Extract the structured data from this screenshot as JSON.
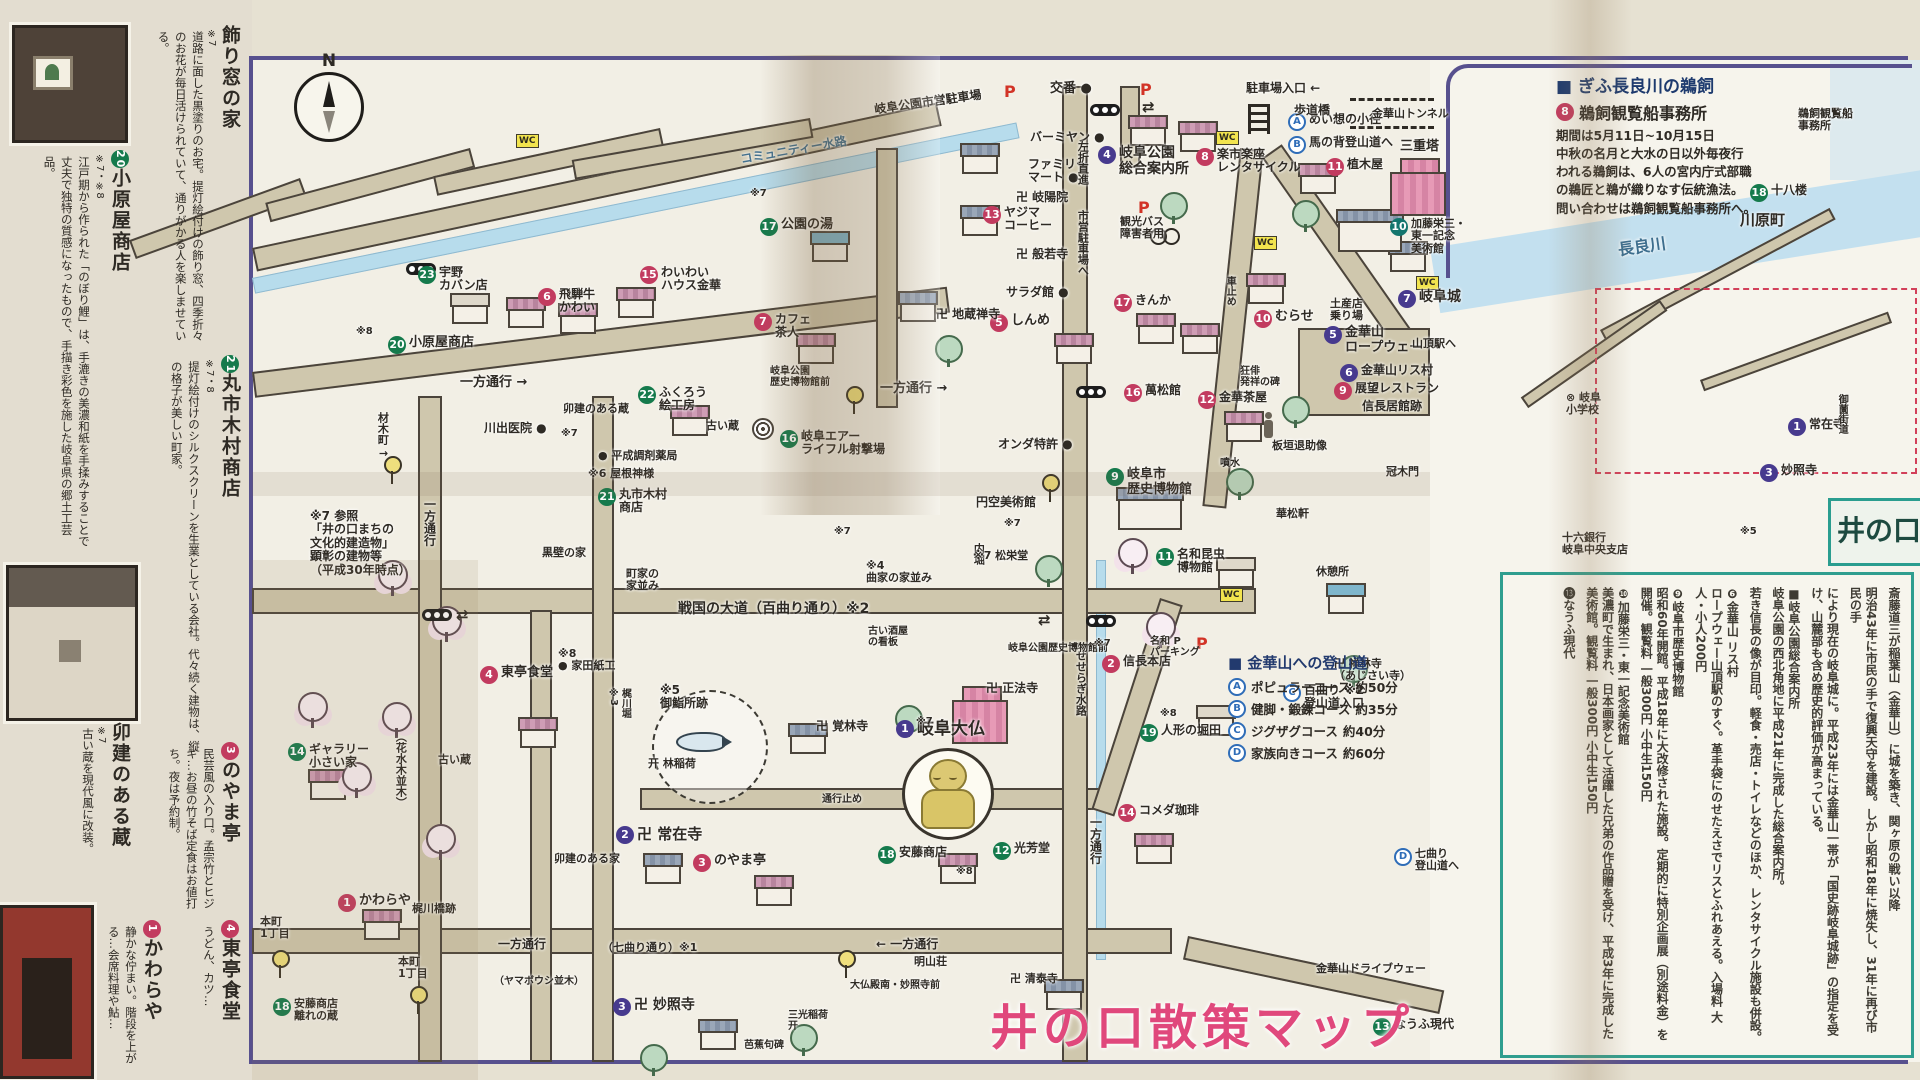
{
  "title": {
    "text": "井の口散策マップ"
  },
  "compass": {
    "n": "N"
  },
  "colors": {
    "pink": "#c23b5f",
    "green": "#157a4c",
    "teal": "#13756d",
    "purple": "#473a8e",
    "letter_blue": "#2f6db8",
    "title_pink": "#e0487c",
    "road": "#cfc7ad",
    "water": "#b7dcec",
    "accent_teal": "#2f9e8f",
    "sheet_border": "#57508e"
  },
  "legend": {
    "title": "■ 金華山への登山道",
    "items": [
      {
        "key": "A",
        "label": "ポピュラーコース",
        "time": "約50分"
      },
      {
        "key": "B",
        "label": "健脚・鍛錬コース",
        "time": "約35分"
      },
      {
        "key": "C",
        "label": "ジグザグコース",
        "time": "約40分"
      },
      {
        "key": "D",
        "label": "家族向きコース",
        "time": "約60分"
      }
    ]
  },
  "right": {
    "ukai": {
      "heading": "■ ぎふ長良川の鵜飼",
      "sub_num": "8",
      "sub_text": "鵜飼観覧船事務所",
      "body": "期間は5月11日~10月15日\n中秋の名月と大水の日以外毎夜行\nわれる鵜飼は、6人の宮内庁式部職\nの鵜匠と鵜が織りなす伝統漁法。\n問い合わせは鵜飼観覧船事務所へ。"
    },
    "inokuchi": "井の口",
    "columns": [
      "斎藤道三が稲葉山（金華山）に城を築き、関ヶ原の戦い以降",
      "明治43年に市民の手で復興天守を建設。しかし昭和18年に焼失し、31年に再び市民の手",
      "により現在の岐阜城に。平成23年には金華山一帯が「国史跡岐阜城跡」の指定を受け、山麓部も含め歴史的評価が高まっている。",
      "■岐阜公園総合案内所\n岐阜公園の西北角地に平成21年に完成した総合案内所。",
      "若き信長の像が目印。軽食・売店・トイレなどのほか、レンタサイクル施設も併設。",
      "❻金華山 リス村\nロープウェー山頂駅のすぐ。革手袋にのせたえさでリスとふれあえる。入場料 大人・小人200円",
      "❾岐阜市歴史博物館\n昭和60年開館。平成18年に大改修された施設。定期的に特別企画展（別途料金）を開催。観覧料 一般300円 小中生150円",
      "❿加藤栄三・東一記念美術館\n美濃町で生まれ、日本画家として活躍した兄弟の作品贈を受け、平成3年に完成した美術館。観覧料 一般300円 小中生150円",
      "⓭なうふ現代"
    ]
  },
  "left": {
    "sections": [
      {
        "num": "",
        "nc": "",
        "title": "飾り窓の家",
        "note": "※7",
        "body": "道路に面した黒塗りのお宅。提灯絵付けの飾り窓、四季折々のお花が毎日活けられていて、通りがかる人を楽しませている。"
      },
      {
        "num": "20",
        "nc": "green",
        "title": "小原屋商店",
        "note": "※7・※8",
        "body": "江戸期から作られた「のぼり鯉」は、手漉きの美濃和紙を手揉みすることで丈夫で独特の質感になったもので、手描き彩色を施した岐阜県の郷土工芸品。"
      },
      {
        "num": "21",
        "nc": "green",
        "title": "丸市木村商店",
        "note": "※7・8",
        "body": "提灯絵付けのシルクスクリーンを生業としている会社。代々続く建物は、縦の格子が美しい町家。"
      },
      {
        "num": "",
        "nc": "",
        "title": "卯建のある蔵",
        "note": "※7",
        "body": "古い蔵を現代風に改装。"
      },
      {
        "num": "3",
        "nc": "pink",
        "title": "のやま亭",
        "note": "",
        "body": "民芸風の入り口。孟宗竹とヒジキ…お昼の竹そば定食はお値打ち。夜は予約制。"
      },
      {
        "num": "1",
        "nc": "pink",
        "title": "かわらや",
        "note": "",
        "body": "静かな佇まい。階段を上がる…会席料理や鮎…"
      },
      {
        "num": "4",
        "nc": "pink",
        "title": "東亭食堂",
        "note": "",
        "body": "うどん、カツ…"
      }
    ]
  },
  "map": {
    "items": [
      {
        "s": "purple",
        "n": "1",
        "t": "岐阜大仏",
        "x": 896,
        "y": 720,
        "fs": 17,
        "b": 1
      },
      {
        "s": "purple",
        "n": "2",
        "t": "卍 常在寺",
        "x": 616,
        "y": 826,
        "fs": 15
      },
      {
        "s": "purple",
        "n": "3",
        "t": "卍 妙照寺",
        "x": 613,
        "y": 998,
        "fs": 14
      },
      {
        "s": "purple",
        "n": "4",
        "t": "岐阜公園\n総合案内所",
        "x": 1098,
        "y": 146,
        "fs": 14,
        "b": 1
      },
      {
        "s": "purple",
        "n": "5",
        "t": "金華山\nロープウェー",
        "x": 1324,
        "y": 326,
        "fs": 13
      },
      {
        "s": "purple",
        "n": "6",
        "t": "金華山リス村",
        "x": 1340,
        "y": 364,
        "fs": 12
      },
      {
        "s": "purple",
        "n": "7",
        "t": "岐阜城",
        "x": 1398,
        "y": 290,
        "fs": 14
      },
      {
        "s": "letter",
        "n": "A",
        "t": "めい想の小径",
        "x": 1288,
        "y": 113,
        "fs": 12
      },
      {
        "s": "letter",
        "n": "B",
        "t": "馬の背登山道へ",
        "x": 1288,
        "y": 136,
        "fs": 12
      },
      {
        "s": "letter",
        "n": "C",
        "t": "百曲り ※2\n登山道入口",
        "x": 1283,
        "y": 684,
        "fs": 12
      },
      {
        "s": "letter",
        "n": "D",
        "t": "七曲り\n登山道へ",
        "x": 1394,
        "y": 848,
        "fs": 11
      },
      {
        "s": "pink",
        "n": "1",
        "t": "かわらや",
        "x": 338,
        "y": 894,
        "fs": 13
      },
      {
        "s": "pink",
        "n": "2",
        "t": "信長本店",
        "x": 1102,
        "y": 655,
        "fs": 12
      },
      {
        "s": "pink",
        "n": "3",
        "t": "のやま亭",
        "x": 693,
        "y": 854,
        "fs": 13
      },
      {
        "s": "pink",
        "n": "4",
        "t": "東亭食堂",
        "x": 480,
        "y": 666,
        "fs": 13
      },
      {
        "s": "pink",
        "n": "5",
        "t": "しんめ",
        "x": 990,
        "y": 314,
        "fs": 13
      },
      {
        "s": "pink",
        "n": "6",
        "t": "飛騨牛\nかわい",
        "x": 538,
        "y": 288,
        "fs": 12
      },
      {
        "s": "pink",
        "n": "7",
        "t": "カフェ\n茶人",
        "x": 754,
        "y": 313,
        "fs": 12
      },
      {
        "s": "pink",
        "n": "8",
        "t": "楽市楽座\nレンタサイクル",
        "x": 1196,
        "y": 148,
        "fs": 12
      },
      {
        "s": "pink",
        "n": "9",
        "t": "展望レストラン",
        "x": 1334,
        "y": 382,
        "fs": 12
      },
      {
        "s": "pink",
        "n": "10",
        "t": "むらせ",
        "x": 1254,
        "y": 310,
        "fs": 13
      },
      {
        "s": "pink",
        "n": "11",
        "t": "植木屋",
        "x": 1326,
        "y": 158,
        "fs": 12
      },
      {
        "s": "pink",
        "n": "12",
        "t": "金華茶屋",
        "x": 1198,
        "y": 391,
        "fs": 12
      },
      {
        "s": "pink",
        "n": "13",
        "t": "ヤジマ\nコーヒー",
        "x": 983,
        "y": 206,
        "fs": 12
      },
      {
        "s": "pink",
        "n": "14",
        "t": "コメダ珈琲",
        "x": 1118,
        "y": 804,
        "fs": 12
      },
      {
        "s": "pink",
        "n": "15",
        "t": "わいわい\nハウス金華",
        "x": 640,
        "y": 266,
        "fs": 12
      },
      {
        "s": "pink",
        "n": "16",
        "t": "萬松館",
        "x": 1124,
        "y": 384,
        "fs": 12
      },
      {
        "s": "pink",
        "n": "17",
        "t": "きんか",
        "x": 1114,
        "y": 294,
        "fs": 12
      },
      {
        "s": "green",
        "n": "9",
        "t": "岐阜市\n歴史博物館",
        "x": 1106,
        "y": 468,
        "fs": 13,
        "b": 1
      },
      {
        "s": "teal",
        "n": "10",
        "t": "加藤栄三・\n東一記念\n美術館",
        "x": 1390,
        "y": 218,
        "fs": 11
      },
      {
        "s": "green",
        "n": "11",
        "t": "名和昆虫\n博物館",
        "x": 1156,
        "y": 548,
        "fs": 12
      },
      {
        "s": "green",
        "n": "12",
        "t": "光芳堂",
        "x": 993,
        "y": 842,
        "fs": 12
      },
      {
        "s": "green",
        "n": "13",
        "t": "なうふ現代",
        "x": 1373,
        "y": 1018,
        "fs": 12
      },
      {
        "s": "green",
        "n": "14",
        "t": "ギャラリー\n小さい家",
        "x": 288,
        "y": 743,
        "fs": 12
      },
      {
        "s": "green",
        "n": "16",
        "t": "岐阜エアー\nライフル射撃場",
        "x": 780,
        "y": 430,
        "fs": 12
      },
      {
        "s": "green",
        "n": "17",
        "t": "公園の湯",
        "x": 760,
        "y": 218,
        "fs": 13
      },
      {
        "s": "green",
        "n": "18",
        "t": "安藤商店",
        "x": 878,
        "y": 846,
        "fs": 12
      },
      {
        "s": "green",
        "n": "18",
        "t": "安藤商店\n離れの蔵",
        "x": 273,
        "y": 998,
        "fs": 11
      },
      {
        "s": "green",
        "n": "19",
        "t": "人形の堀田",
        "x": 1140,
        "y": 724,
        "fs": 12
      },
      {
        "s": "green",
        "n": "20",
        "t": "小原屋商店",
        "x": 388,
        "y": 336,
        "fs": 13
      },
      {
        "s": "green",
        "n": "21",
        "t": "丸市木村\n商店",
        "x": 598,
        "y": 488,
        "fs": 12
      },
      {
        "s": "green",
        "n": "22",
        "t": "ふくろう\n絵工房",
        "x": 638,
        "y": 386,
        "fs": 12
      },
      {
        "s": "green",
        "n": "23",
        "t": "宇野\nカバン店",
        "x": 418,
        "y": 266,
        "fs": 12
      },
      {
        "s": "green",
        "n": "18",
        "t": "十八楼",
        "x": 1750,
        "y": 184,
        "fs": 12
      },
      {
        "s": "purple",
        "n": "1",
        "t": "常在寺",
        "x": 1788,
        "y": 418,
        "fs": 12
      },
      {
        "s": "purple",
        "n": "3",
        "t": "妙照寺",
        "x": 1760,
        "y": 464,
        "fs": 12
      },
      {
        "t": "交番 ●",
        "x": 1050,
        "y": 82,
        "fs": 13
      },
      {
        "t": "駐車場入口 ←",
        "x": 1246,
        "y": 82,
        "fs": 12
      },
      {
        "t": "歩道橋",
        "x": 1294,
        "y": 104,
        "fs": 12
      },
      {
        "t": "金華山トンネル",
        "x": 1372,
        "y": 108,
        "fs": 11
      },
      {
        "t": "三重塔",
        "x": 1400,
        "y": 140,
        "fs": 13
      },
      {
        "t": "卍 岐陽院",
        "x": 1016,
        "y": 191,
        "fs": 12
      },
      {
        "t": "卍 般若寺",
        "x": 1016,
        "y": 248,
        "fs": 12
      },
      {
        "t": "バーミヤン ●",
        "x": 1030,
        "y": 131,
        "fs": 12
      },
      {
        "t": "ファミリー\nマート ●",
        "x": 1028,
        "y": 158,
        "fs": 12
      },
      {
        "t": "左折直進",
        "x": 1076,
        "y": 141,
        "v": 1,
        "fs": 11
      },
      {
        "t": "市営駐車場へ",
        "x": 1076,
        "y": 210,
        "v": 1,
        "fs": 11
      },
      {
        "t": "サラダ館 ●",
        "x": 1006,
        "y": 286,
        "fs": 12
      },
      {
        "t": "卍 地蔵禅寺",
        "x": 936,
        "y": 308,
        "fs": 12
      },
      {
        "t": "観光バス\n障害者用",
        "x": 1120,
        "y": 216,
        "fs": 11
      },
      {
        "t": "車止め",
        "x": 1224,
        "y": 276,
        "v": 1,
        "fs": 10
      },
      {
        "t": "土産店\n乗り場",
        "x": 1330,
        "y": 298,
        "fs": 11
      },
      {
        "t": "山頂駅へ",
        "x": 1412,
        "y": 338,
        "fs": 11
      },
      {
        "t": "信長居館跡",
        "x": 1362,
        "y": 400,
        "fs": 12
      },
      {
        "t": "板垣退助像",
        "x": 1272,
        "y": 440,
        "fs": 11
      },
      {
        "t": "冠木門",
        "x": 1386,
        "y": 466,
        "fs": 11
      },
      {
        "t": "噴水",
        "x": 1220,
        "y": 458,
        "fs": 10
      },
      {
        "t": "華松軒",
        "x": 1276,
        "y": 508,
        "fs": 11
      },
      {
        "t": "休憩所",
        "x": 1316,
        "y": 566,
        "fs": 11
      },
      {
        "t": "卍 禅林寺\n（あじさい寺）",
        "x": 1334,
        "y": 658,
        "fs": 11
      },
      {
        "t": "狂俳\n発祥の碑",
        "x": 1240,
        "y": 366,
        "fs": 10
      },
      {
        "t": "一方通行 →",
        "x": 460,
        "y": 376,
        "fs": 13
      },
      {
        "t": "一方通行 →",
        "x": 880,
        "y": 382,
        "fs": 13
      },
      {
        "t": "一方通行",
        "x": 1088,
        "y": 816,
        "v": 1,
        "fs": 12
      },
      {
        "t": "← 一方通行",
        "x": 876,
        "y": 938,
        "fs": 12
      },
      {
        "t": "一方通行",
        "x": 498,
        "y": 938,
        "fs": 12
      },
      {
        "t": "一方通行",
        "x": 422,
        "y": 498,
        "v": 1,
        "fs": 12
      },
      {
        "t": "材木町 ↑",
        "x": 376,
        "y": 412,
        "v": 1,
        "fs": 11
      },
      {
        "t": "本町\n1丁目",
        "x": 260,
        "y": 916,
        "fs": 11
      },
      {
        "t": "本町\n1丁目",
        "x": 398,
        "y": 956,
        "fs": 11
      },
      {
        "t": "戦国の大道（百曲り通り）※2",
        "x": 678,
        "y": 602,
        "fs": 14,
        "b": 1
      },
      {
        "t": "（七曲り通り）※1",
        "x": 602,
        "y": 942,
        "fs": 11
      },
      {
        "t": "（ヤマボウシ並木）",
        "x": 494,
        "y": 976,
        "fs": 10
      },
      {
        "t": "（花水木並木）",
        "x": 394,
        "y": 731,
        "v": 1,
        "fs": 11
      },
      {
        "t": "せせらぎ水路",
        "x": 1074,
        "y": 650,
        "v": 1,
        "fs": 11
      },
      {
        "t": "内堀",
        "x": 972,
        "y": 543,
        "v": 1,
        "fs": 11
      },
      {
        "t": "梶川堀\n※3",
        "x": 608,
        "y": 688,
        "v": 1,
        "fs": 10
      },
      {
        "t": "梶川橋跡",
        "x": 412,
        "y": 903,
        "fs": 11
      },
      {
        "t": "※5\n御鮨所跡",
        "x": 660,
        "y": 684,
        "fs": 12
      },
      {
        "t": "※8\n● 家田紙工",
        "x": 558,
        "y": 648,
        "fs": 11
      },
      {
        "t": "古い蔵",
        "x": 706,
        "y": 420,
        "fs": 11
      },
      {
        "t": "古い蔵",
        "x": 438,
        "y": 754,
        "fs": 11
      },
      {
        "t": "卯建のある蔵",
        "x": 563,
        "y": 403,
        "fs": 11
      },
      {
        "t": "卯建のある家",
        "x": 554,
        "y": 853,
        "fs": 11
      },
      {
        "t": "黒壁の家",
        "x": 542,
        "y": 547,
        "fs": 11
      },
      {
        "t": "町家の\n家並み",
        "x": 626,
        "y": 568,
        "fs": 11
      },
      {
        "t": "※4\n曲家の家並み",
        "x": 866,
        "y": 560,
        "fs": 11
      },
      {
        "t": "古い酒屋\nの看板",
        "x": 868,
        "y": 626,
        "fs": 10
      },
      {
        "t": "※6 屋根神様",
        "x": 588,
        "y": 468,
        "fs": 11
      },
      {
        "t": "● 平成調剤薬局",
        "x": 598,
        "y": 450,
        "fs": 11
      },
      {
        "t": "川出医院 ●",
        "x": 484,
        "y": 422,
        "fs": 12
      },
      {
        "t": "オンダ特許 ●",
        "x": 998,
        "y": 438,
        "fs": 12
      },
      {
        "t": "円空美術館",
        "x": 976,
        "y": 496,
        "fs": 12
      },
      {
        "t": "※7 松栄堂",
        "x": 973,
        "y": 550,
        "fs": 11
      },
      {
        "t": "岐阜公園\n歴史博物館前",
        "x": 770,
        "y": 366,
        "fs": 10
      },
      {
        "t": "岐阜公園歴史博物館前",
        "x": 1008,
        "y": 643,
        "fs": 10
      },
      {
        "t": "大仏殿南・妙照寺前",
        "x": 850,
        "y": 980,
        "fs": 10
      },
      {
        "t": "明山荘",
        "x": 914,
        "y": 956,
        "fs": 11
      },
      {
        "t": "卍 清泰寺",
        "x": 1010,
        "y": 973,
        "fs": 11
      },
      {
        "t": "金華山ドライブウェー",
        "x": 1316,
        "y": 963,
        "fs": 11
      },
      {
        "t": "通行止め",
        "x": 822,
        "y": 794,
        "fs": 10
      },
      {
        "t": "开 林稲荷",
        "x": 648,
        "y": 758,
        "fs": 11
      },
      {
        "t": "卍 覚林寺",
        "x": 816,
        "y": 720,
        "fs": 12
      },
      {
        "t": "卍 正法寺",
        "x": 986,
        "y": 682,
        "fs": 12
      },
      {
        "t": "三光稲荷\n开",
        "x": 788,
        "y": 1010,
        "fs": 10
      },
      {
        "t": "芭蕉句碑",
        "x": 744,
        "y": 1040,
        "fs": 10
      },
      {
        "t": "名和 P\nパーキング",
        "x": 1150,
        "y": 636,
        "fs": 10
      },
      {
        "t": "※7",
        "x": 1094,
        "y": 638,
        "fs": 10
      },
      {
        "t": "※8",
        "x": 1160,
        "y": 708,
        "fs": 10
      },
      {
        "t": "※8",
        "x": 356,
        "y": 326,
        "fs": 10
      },
      {
        "t": "※8",
        "x": 956,
        "y": 866,
        "fs": 10
      },
      {
        "t": "※7",
        "x": 750,
        "y": 188,
        "fs": 10
      },
      {
        "t": "※7",
        "x": 561,
        "y": 428,
        "fs": 10
      },
      {
        "t": "※7",
        "x": 834,
        "y": 526,
        "fs": 10
      },
      {
        "t": "※7",
        "x": 916,
        "y": 716,
        "fs": 10
      },
      {
        "t": "※7",
        "x": 1004,
        "y": 518,
        "fs": 10
      },
      {
        "t": "※7 参照\n「井の口まちの\n文化的建造物」\n顕彰の建物等\n（平成30年時点）",
        "x": 310,
        "y": 510,
        "fs": 12
      },
      {
        "t": "岐阜公園市営駐車場",
        "x": 874,
        "y": 96,
        "fs": 12,
        "r": -8
      },
      {
        "t": "コミュニティー水路",
        "x": 740,
        "y": 144,
        "fs": 12,
        "r": -10,
        "c": "#44718e"
      },
      {
        "t": "長良川",
        "x": 1618,
        "y": 238,
        "fs": 16,
        "b": 1,
        "r": -8,
        "c": "#3d6e8e"
      },
      {
        "t": "川原町",
        "x": 1740,
        "y": 212,
        "fs": 15
      },
      {
        "t": "鵜飼観覧船\n事務所",
        "x": 1798,
        "y": 108,
        "fs": 11
      },
      {
        "t": "⊗ 岐阜\n小学校",
        "x": 1566,
        "y": 392,
        "fs": 11
      },
      {
        "t": "十六銀行\n岐阜中央支店",
        "x": 1562,
        "y": 532,
        "fs": 11
      },
      {
        "t": "御薗街道",
        "x": 1836,
        "y": 394,
        "v": 1,
        "fs": 10
      },
      {
        "t": "※5",
        "x": 1740,
        "y": 526,
        "fs": 10
      }
    ],
    "wc": [
      [
        516,
        134
      ],
      [
        1216,
        131
      ],
      [
        1254,
        236
      ],
      [
        1416,
        276
      ],
      [
        1220,
        588
      ]
    ],
    "p": [
      [
        1004,
        84
      ],
      [
        1140,
        82
      ],
      [
        1138,
        200
      ],
      [
        1196,
        636
      ]
    ],
    "sig": [
      [
        406,
        263
      ],
      [
        1090,
        104
      ],
      [
        1076,
        386
      ],
      [
        422,
        609
      ],
      [
        1086,
        615
      ]
    ],
    "bus": [
      [
        846,
        386
      ],
      [
        1042,
        474
      ],
      [
        384,
        456
      ],
      [
        272,
        950
      ],
      [
        410,
        986
      ],
      [
        838,
        950
      ]
    ],
    "arr": [
      [
        1142,
        98
      ],
      [
        456,
        606
      ],
      [
        1038,
        611
      ]
    ]
  }
}
